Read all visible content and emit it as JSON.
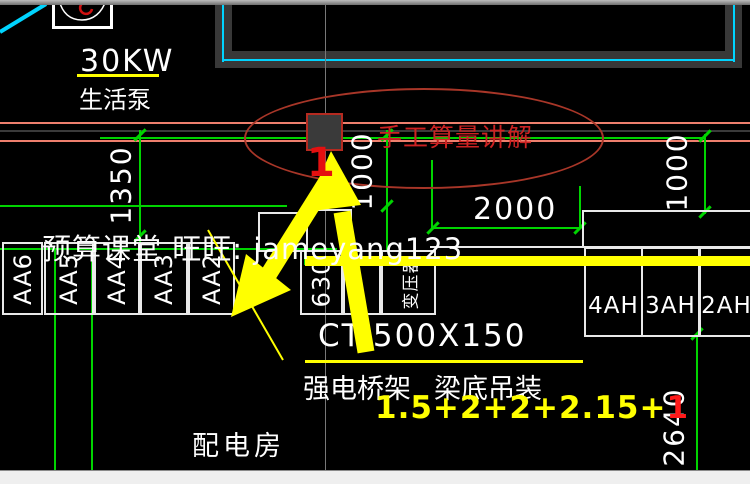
{
  "drawing": {
    "pump": {
      "power": "30KW",
      "name": "生活泵"
    },
    "room": {
      "name": "配电房"
    },
    "tray": {
      "size": "CT-500X150",
      "left_desc": "强电桥架",
      "right_desc": "梁底吊装"
    },
    "dimensions": {
      "left": "1350",
      "middle": "1000",
      "top": "2000",
      "right": "1000",
      "bottom_right": "2640"
    },
    "panels": {
      "left": [
        {
          "label": "AA6"
        },
        {
          "label": "AA5"
        },
        {
          "label": "AA4"
        },
        {
          "label": "AA3"
        },
        {
          "label": "AA2"
        }
      ],
      "middle": [
        {
          "label": "630"
        },
        {
          "label": ""
        },
        {
          "label": "变压器"
        }
      ],
      "right": [
        {
          "label": "4AH"
        },
        {
          "label": "3AH"
        },
        {
          "label": "2AH"
        }
      ]
    }
  },
  "annotations": {
    "circled_title": "手工算量讲解",
    "marker": "1",
    "formula_main": "1.5+2+2+2.15+",
    "formula_suffix": "1",
    "watermark": "预算课堂 旺旺: jameyang123"
  },
  "colors": {
    "background": "#000000",
    "dimension_green": "#00d400",
    "highlight_yellow": "#ffff00",
    "annotation_red": "#cc2222",
    "supply_line_salmon": "#ee7f6d",
    "conduit_cyan": "#00d4ff",
    "wall_gray": "#383838"
  }
}
